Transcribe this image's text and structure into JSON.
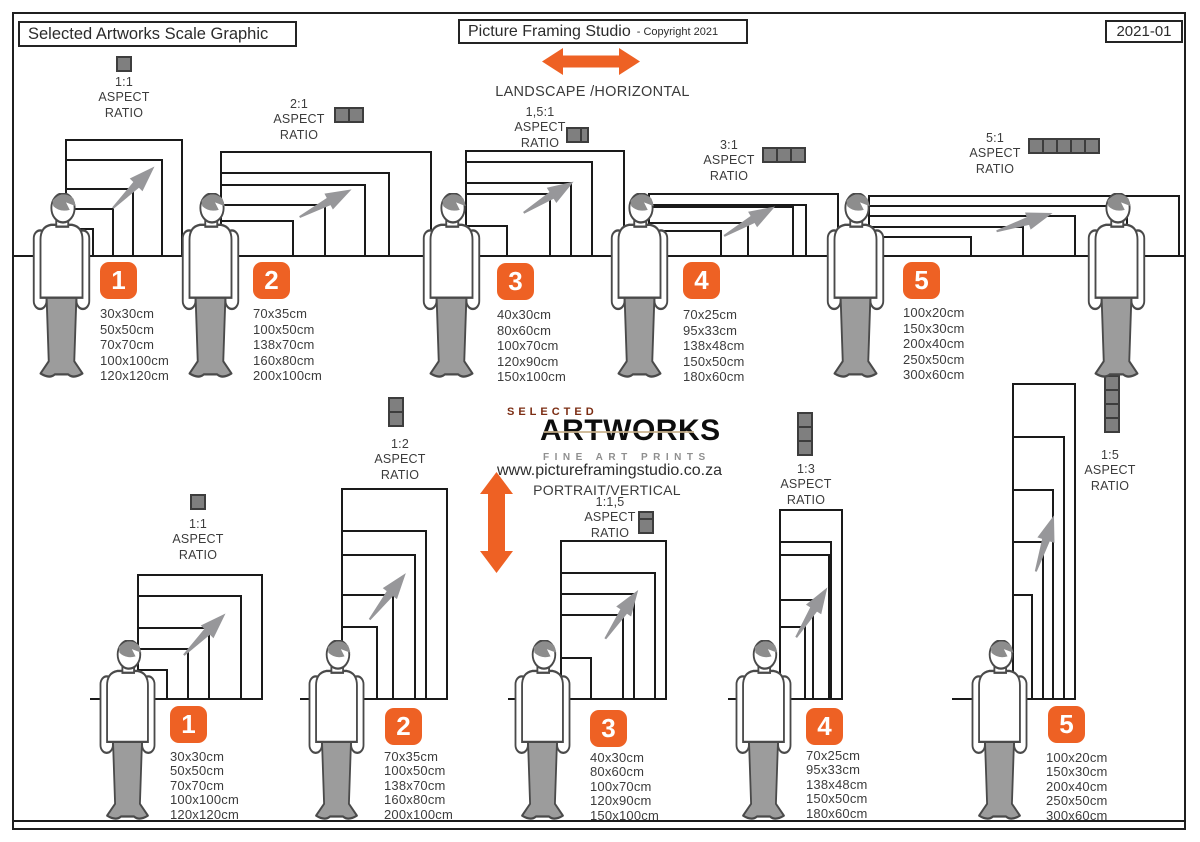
{
  "header": {
    "left_title": "Selected Artworks Scale Graphic",
    "center_title": "Picture Framing Studio",
    "center_suffix": "- Copyright 2021",
    "right_code": "2021-01"
  },
  "labels": {
    "aspect": "ASPECT",
    "ratio": "RATIO"
  },
  "landscape": {
    "direction": "LANDSCAPE /HORIZONTAL",
    "groups": [
      {
        "number": "1",
        "ratio": "1:1",
        "sizes": [
          "30x30cm",
          "50x50cm",
          "70x70cm",
          "100x100cm",
          "120x120cm"
        ]
      },
      {
        "number": "2",
        "ratio": "2:1",
        "sizes": [
          "70x35cm",
          "100x50cm",
          "138x70cm",
          "160x80cm",
          "200x100cm"
        ]
      },
      {
        "number": "3",
        "ratio": "1,5:1",
        "sizes": [
          "40x30cm",
          "80x60cm",
          "100x70cm",
          "120x90cm",
          "150x100cm"
        ]
      },
      {
        "number": "4",
        "ratio": "3:1",
        "sizes": [
          "70x25cm",
          "95x33cm",
          "138x48cm",
          "150x50cm",
          "180x60cm"
        ]
      },
      {
        "number": "5",
        "ratio": "5:1",
        "sizes": [
          "100x20cm",
          "150x30cm",
          "200x40cm",
          "250x50cm",
          "300x60cm"
        ]
      }
    ]
  },
  "portrait": {
    "direction": "PORTRAIT/VERTICAL",
    "website": "www.pictureframingstudio.co.za",
    "logo": {
      "top": "SELECTED",
      "main": "ARTWORKS",
      "sub": "FINE ART PRINTS"
    },
    "groups": [
      {
        "number": "1",
        "ratio": "1:1",
        "sizes": [
          "30x30cm",
          "50x50cm",
          "70x70cm",
          "100x100cm",
          "120x120cm"
        ]
      },
      {
        "number": "2",
        "ratio": "1:2",
        "sizes": [
          "70x35cm",
          "100x50cm",
          "138x70cm",
          "160x80cm",
          "200x100cm"
        ]
      },
      {
        "number": "3",
        "ratio": "1:1,5",
        "sizes": [
          "40x30cm",
          "80x60cm",
          "100x70cm",
          "120x90cm",
          "150x100cm"
        ]
      },
      {
        "number": "4",
        "ratio": "1:3",
        "sizes": [
          "70x25cm",
          "95x33cm",
          "138x48cm",
          "150x50cm",
          "180x60cm"
        ]
      },
      {
        "number": "5",
        "ratio": "1:5",
        "sizes": [
          "100x20cm",
          "150x30cm",
          "200x40cm",
          "250x50cm",
          "300x60cm"
        ]
      }
    ]
  },
  "colors": {
    "accent_orange": "#ee6124",
    "frame_black": "#1a1a1a",
    "gray": "#7f7f7f"
  }
}
